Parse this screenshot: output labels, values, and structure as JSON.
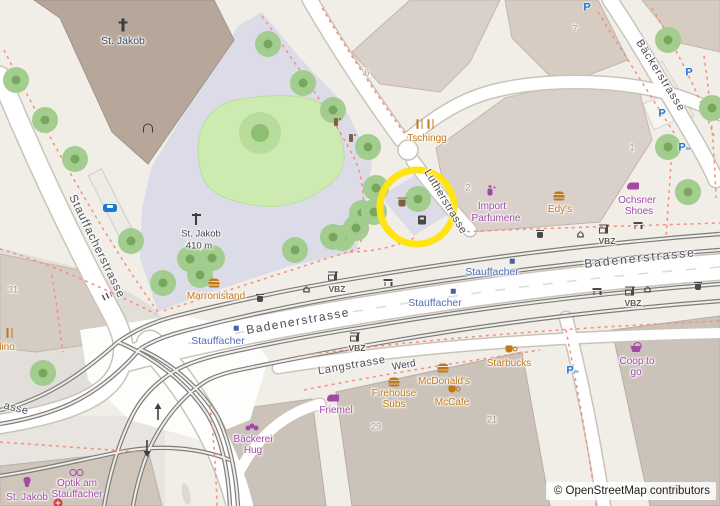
{
  "colors": {
    "food": "#c17817",
    "shop": "#a349a4",
    "transit_blue": "#4d6fb5",
    "street_text": "#4d4d57",
    "vbz_text": "#5c5c49",
    "house_number": "#a5988b",
    "highlight_yellow": "#ffe415",
    "park_green": "#cdebb0",
    "pedestrian": "#dcdce8",
    "building": "#d9d0c9",
    "parking_blue": "#1f78d1"
  },
  "attribution": {
    "text": "© OpenStreetMap contributors"
  },
  "highlight": {
    "cx": 417,
    "cy": 207,
    "r": 37,
    "width": 7,
    "color": "#ffe415"
  },
  "streets": [
    {
      "name": "Stauffacherstrasse",
      "x": 96,
      "y": 247,
      "rot": 64,
      "size": 11.5,
      "spacing": 1
    },
    {
      "name": "Badenerstrasse",
      "x": 640,
      "y": 258,
      "rot": -6,
      "size": 12,
      "spacing": 2
    },
    {
      "name": "Badenerstrasse",
      "x": 298,
      "y": 321,
      "rot": -10,
      "size": 12,
      "spacing": 1.5
    },
    {
      "name": "Langstrasse",
      "x": 352,
      "y": 366,
      "rot": -10,
      "size": 11,
      "spacing": 0.8
    },
    {
      "name": "Lutherstrasse",
      "x": 445,
      "y": 202,
      "rot": 59,
      "size": 11,
      "spacing": 0.5
    },
    {
      "name": "Bäckerstrasse",
      "x": 660,
      "y": 76,
      "rot": 58,
      "size": 11,
      "spacing": 1
    },
    {
      "name": "asse",
      "x": 16,
      "y": 409,
      "rot": 14,
      "size": 11,
      "spacing": 0.5
    }
  ],
  "labels": [
    {
      "t": "St. Jakob",
      "x": 123,
      "y": 41,
      "size": 10.5,
      "color": "#3d4a5f",
      "rot": 0
    },
    {
      "t": "St. Jakob",
      "x": 201,
      "y": 234,
      "size": 9.5,
      "color": "#474747",
      "rot": 0
    },
    {
      "t": "410 m",
      "x": 199,
      "y": 246,
      "size": 9.5,
      "color": "#474747",
      "rot": 0
    },
    {
      "t": "Werd",
      "x": 404,
      "y": 366,
      "size": 10,
      "color": "#434a63",
      "rot": -10
    }
  ],
  "house_numbers": [
    {
      "n": "6",
      "x": 367,
      "y": 73
    },
    {
      "n": "2",
      "x": 468,
      "y": 188
    },
    {
      "n": "1",
      "x": 632,
      "y": 148
    },
    {
      "n": "7",
      "x": 575,
      "y": 29
    },
    {
      "n": "29",
      "x": 376,
      "y": 427
    },
    {
      "n": "21",
      "x": 492,
      "y": 420
    },
    {
      "n": "31",
      "x": 13,
      "y": 290
    }
  ],
  "transit": {
    "stop_name": "Stauffacher",
    "stops": [
      {
        "x": 492,
        "y": 272
      },
      {
        "x": 435,
        "y": 303
      },
      {
        "x": 218,
        "y": 341
      }
    ],
    "operator_name": "VBZ",
    "operators": [
      {
        "x": 337,
        "y": 289
      },
      {
        "x": 607,
        "y": 241
      },
      {
        "x": 633,
        "y": 303
      },
      {
        "x": 357,
        "y": 348
      }
    ],
    "markers": [
      {
        "x": 512,
        "y": 261
      },
      {
        "x": 453,
        "y": 291
      },
      {
        "x": 236,
        "y": 328
      }
    ]
  },
  "pois": [
    {
      "name": "Tschingg",
      "category": "food",
      "icon": "restaurant",
      "ix": 420,
      "iy": 124,
      "lines": [
        {
          "t": "Tschingg",
          "x": 427,
          "y": 139
        }
      ]
    },
    {
      "name": "Edy's",
      "category": "food",
      "icon": "burger",
      "ix": 559,
      "iy": 196,
      "lines": [
        {
          "t": "Edy's",
          "x": 560,
          "y": 210
        }
      ]
    },
    {
      "name": "Marronistand",
      "category": "food",
      "icon": "burger",
      "ix": 214,
      "iy": 283,
      "lines": [
        {
          "t": "Marronistand",
          "x": 216,
          "y": 297
        }
      ]
    },
    {
      "name": "Starbucks",
      "category": "food",
      "icon": "cup",
      "ix": 509,
      "iy": 349,
      "lines": [
        {
          "t": "Starbucks",
          "x": 509,
          "y": 364
        }
      ]
    },
    {
      "name": "McDonald's",
      "category": "food",
      "icon": "burger",
      "ix": 443,
      "iy": 368,
      "lines": [
        {
          "t": "McDonald's",
          "x": 444,
          "y": 382
        }
      ]
    },
    {
      "name": "McCafe",
      "category": "food",
      "icon": "cup",
      "ix": 452,
      "iy": 389,
      "lines": [
        {
          "t": "McCafe",
          "x": 452,
          "y": 403
        }
      ]
    },
    {
      "name": "Firehouse Subs",
      "category": "food",
      "icon": "burger",
      "ix": 394,
      "iy": 382,
      "lines": [
        {
          "t": "Firehouse",
          "x": 394,
          "y": 394
        },
        {
          "t": "Subs",
          "x": 394,
          "y": 405
        }
      ]
    },
    {
      "name": "lino",
      "category": "food",
      "icon": "restaurant",
      "ix": 10,
      "iy": 333,
      "lines": [
        {
          "t": "lino",
          "x": 7,
          "y": 348
        }
      ]
    },
    {
      "name": "Import Parfumerie",
      "category": "shop",
      "icon": "perfume",
      "ix": 490,
      "iy": 192,
      "lines": [
        {
          "t": "Import",
          "x": 492,
          "y": 207
        },
        {
          "t": "Parfumerie",
          "x": 496,
          "y": 219
        }
      ]
    },
    {
      "name": "Ochsner Shoes",
      "category": "shop",
      "icon": "shoe",
      "ix": 633,
      "iy": 186,
      "lines": [
        {
          "t": "Ochsner",
          "x": 637,
          "y": 201
        },
        {
          "t": "Shoes",
          "x": 639,
          "y": 212
        }
      ]
    },
    {
      "name": "Friemel",
      "category": "shop",
      "icon": "shoe",
      "ix": 333,
      "iy": 398,
      "lines": [
        {
          "t": "Friemel",
          "x": 336,
          "y": 411
        }
      ]
    },
    {
      "name": "Bäckerei Hug",
      "category": "shop",
      "icon": "bakery",
      "ix": 252,
      "iy": 426,
      "lines": [
        {
          "t": "Bäckerei",
          "x": 253,
          "y": 440
        },
        {
          "t": "Hug",
          "x": 253,
          "y": 451
        }
      ]
    },
    {
      "name": "Coop to go",
      "category": "shop",
      "icon": "basket",
      "ix": 636,
      "iy": 347,
      "lines": [
        {
          "t": "Coop to",
          "x": 637,
          "y": 362
        },
        {
          "t": "go",
          "x": 636,
          "y": 373
        }
      ]
    },
    {
      "name": "Optik am Stauffacher",
      "category": "shop",
      "icon": "glasses",
      "ix": 76,
      "iy": 472,
      "lines": [
        {
          "t": "Optik am",
          "x": 77,
          "y": 484
        },
        {
          "t": "Stauffacher",
          "x": 77,
          "y": 495
        }
      ]
    },
    {
      "name": "St. Jakob",
      "category": "shop",
      "icon": "cupcake",
      "ix": 27,
      "iy": 482,
      "lines": [
        {
          "t": "St. Jakob",
          "x": 27,
          "y": 498
        }
      ]
    }
  ],
  "parking": [
    {
      "x": 587,
      "y": 8,
      "bike": false
    },
    {
      "x": 689,
      "y": 73,
      "bike": false
    },
    {
      "x": 662,
      "y": 114,
      "bike": false
    },
    {
      "x": 684,
      "y": 148,
      "bike": true
    },
    {
      "x": 572,
      "y": 371,
      "bike": true
    }
  ],
  "furniture": [
    {
      "type": "restaurant",
      "x": 431,
      "y": 124
    },
    {
      "type": "cross",
      "x": 123,
      "y": 25
    },
    {
      "type": "door",
      "x": 148,
      "y": 128
    },
    {
      "type": "guidepost",
      "x": 196,
      "y": 219
    },
    {
      "type": "taxi",
      "x": 110,
      "y": 208
    },
    {
      "type": "fountain",
      "x": 336,
      "y": 122
    },
    {
      "type": "fountain",
      "x": 351,
      "y": 138
    },
    {
      "type": "coffee",
      "x": 402,
      "y": 203
    },
    {
      "type": "atm",
      "x": 422,
      "y": 220
    },
    {
      "type": "bench",
      "x": 388,
      "y": 283
    },
    {
      "type": "bench",
      "x": 597,
      "y": 292
    },
    {
      "type": "bench",
      "x": 638,
      "y": 226
    },
    {
      "type": "bin",
      "x": 540,
      "y": 235
    },
    {
      "type": "bin",
      "x": 698,
      "y": 287
    },
    {
      "type": "bin",
      "x": 260,
      "y": 299
    },
    {
      "type": "shelter",
      "x": 308,
      "y": 289
    },
    {
      "type": "shelter",
      "x": 582,
      "y": 234
    },
    {
      "type": "shelter",
      "x": 649,
      "y": 289
    },
    {
      "type": "tramstop",
      "x": 333,
      "y": 277
    },
    {
      "type": "tramstop",
      "x": 604,
      "y": 230
    },
    {
      "type": "tramstop",
      "x": 630,
      "y": 292
    },
    {
      "type": "tramstop",
      "x": 355,
      "y": 338
    },
    {
      "type": "pharmacy",
      "x": 58,
      "y": 503
    },
    {
      "type": "rails",
      "x": 107,
      "y": 296,
      "rot": -26
    }
  ],
  "trees": {
    "standard": [
      [
        16,
        80
      ],
      [
        45,
        120
      ],
      [
        75,
        159
      ],
      [
        131,
        241
      ],
      [
        268,
        44
      ],
      [
        303,
        83
      ],
      [
        333,
        110
      ],
      [
        368,
        147
      ],
      [
        362,
        213
      ],
      [
        356,
        228
      ],
      [
        342,
        238
      ],
      [
        295,
        250
      ],
      [
        333,
        237
      ],
      [
        190,
        259
      ],
      [
        212,
        258
      ],
      [
        200,
        275
      ],
      [
        163,
        283
      ],
      [
        418,
        199
      ],
      [
        376,
        188
      ],
      [
        374,
        212
      ],
      [
        668,
        40
      ],
      [
        712,
        108
      ],
      [
        668,
        147
      ],
      [
        688,
        192
      ],
      [
        43,
        373
      ]
    ],
    "large": [
      [
        260,
        133
      ]
    ]
  }
}
